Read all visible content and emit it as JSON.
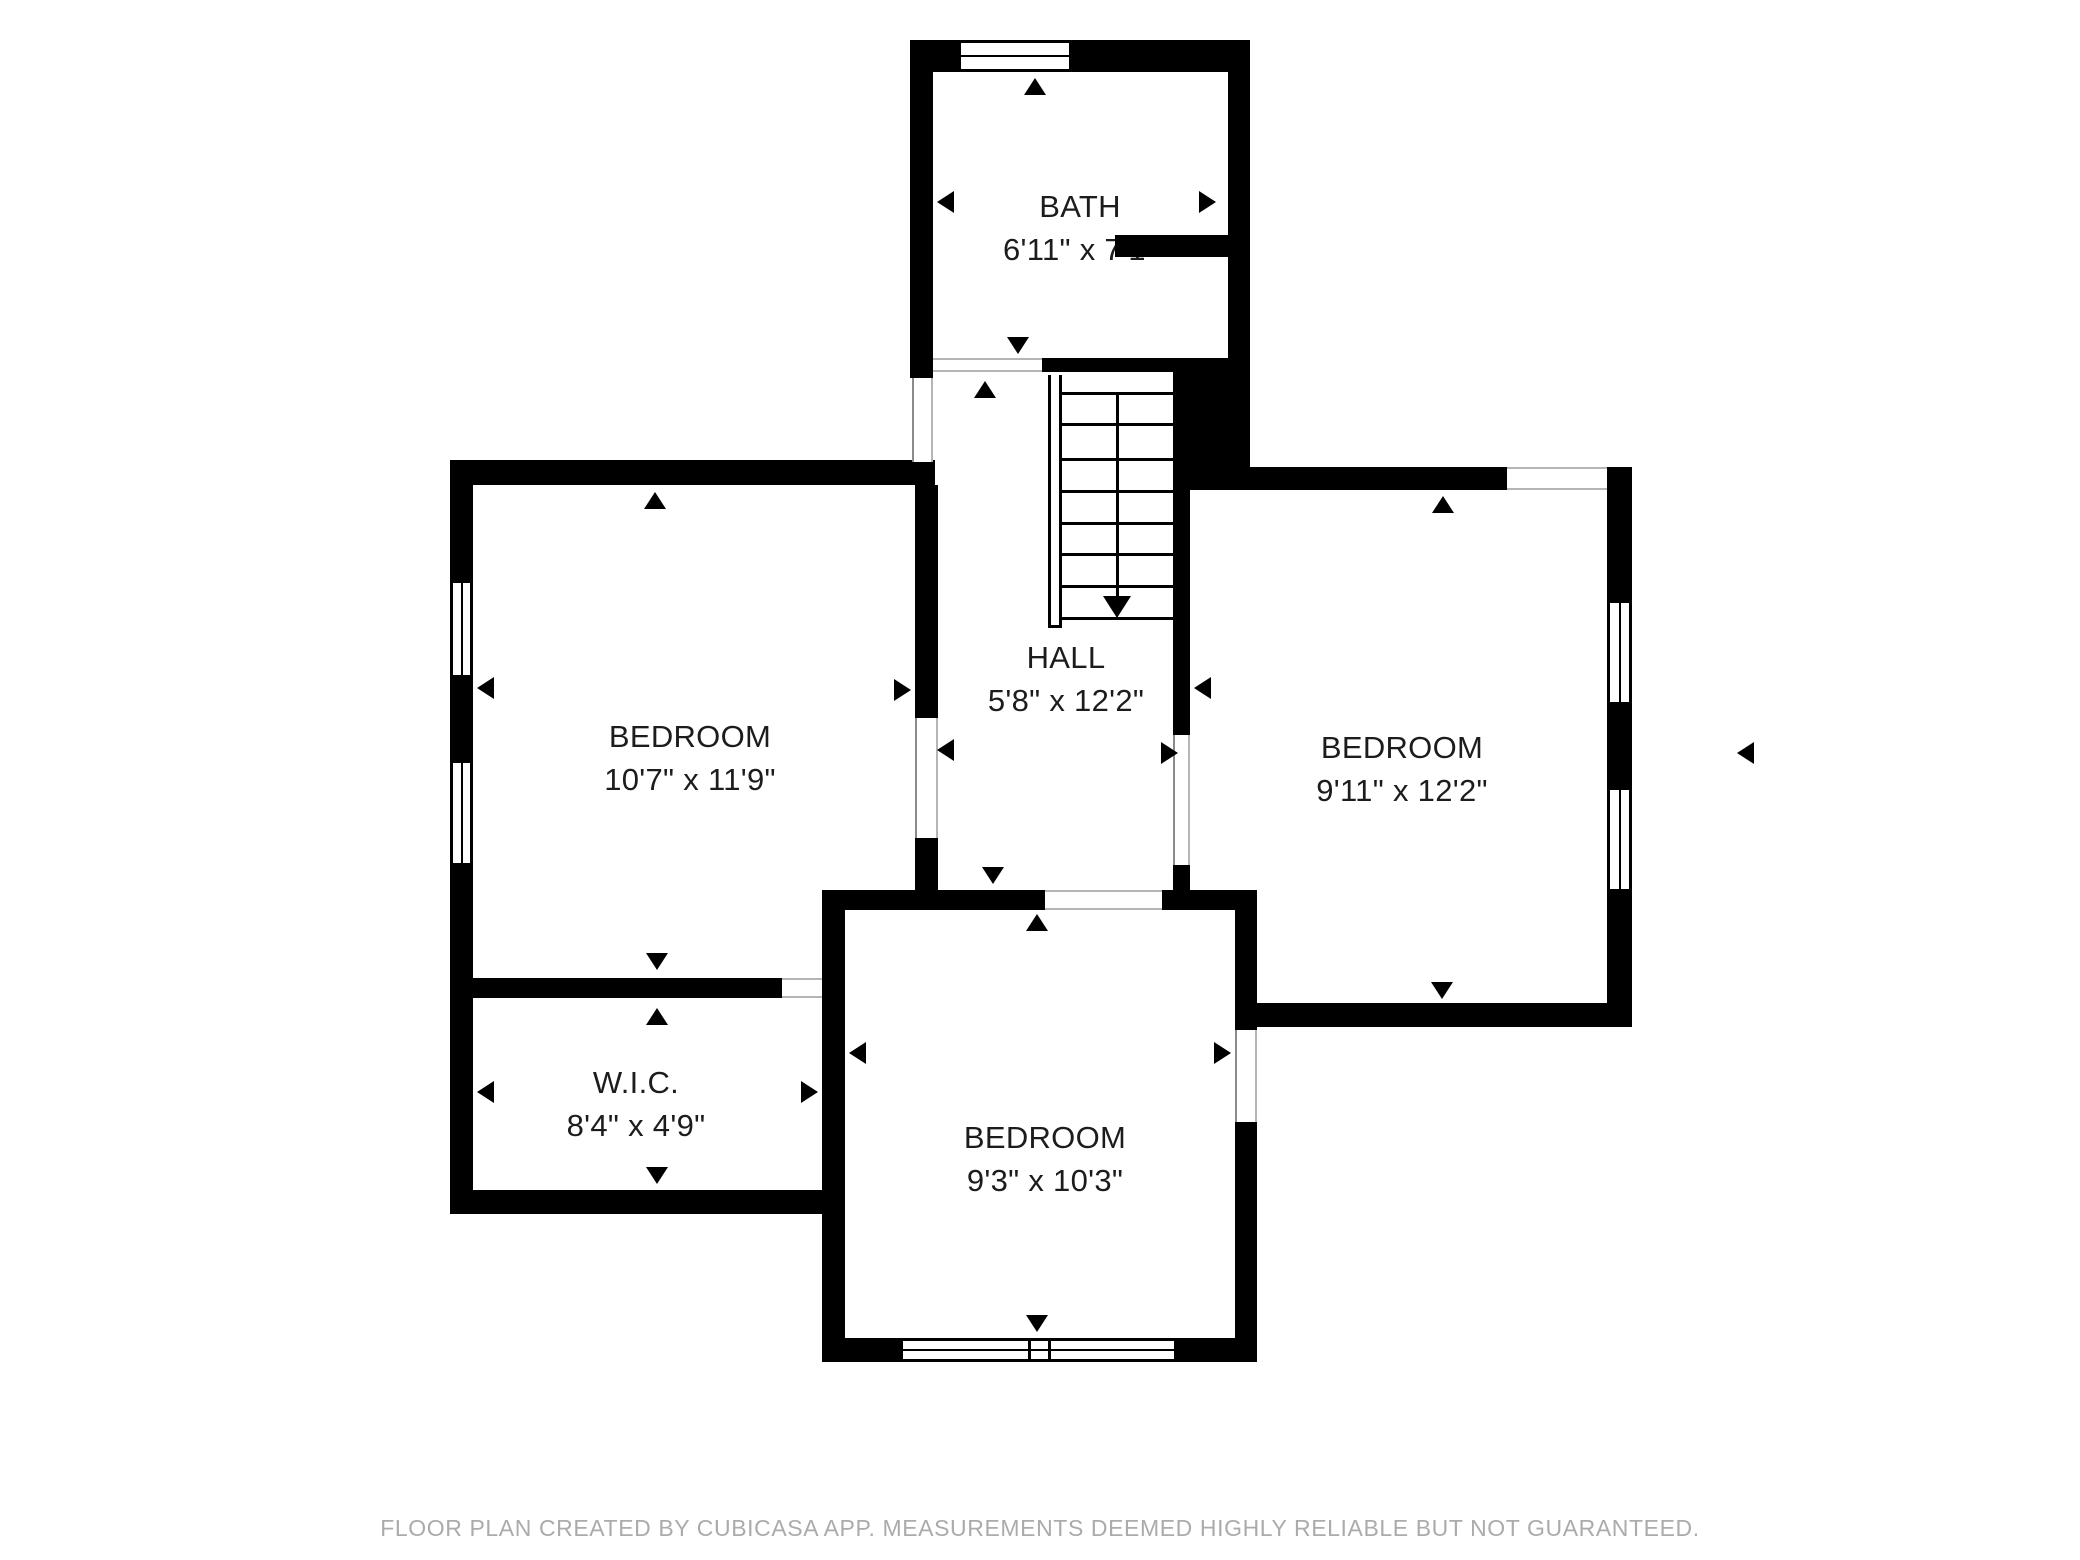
{
  "page": {
    "background": "#ffffff",
    "wall_color": "#000000",
    "label_color": "#1c1c1c",
    "opening_line_color": "#b5b5b5",
    "footer_color": "#ababab"
  },
  "rooms": [
    {
      "id": "bath",
      "name": "BATH",
      "dims": "6'11\" x 7'1\"",
      "cx": 1080,
      "cy": 207
    },
    {
      "id": "hall",
      "name": "HALL",
      "dims": "5'8\" x 12'2\"",
      "cx": 1066,
      "cy": 658
    },
    {
      "id": "bedroom-left",
      "name": "BEDROOM",
      "dims": "10'7\" x 11'9\"",
      "cx": 690,
      "cy": 737
    },
    {
      "id": "bedroom-right",
      "name": "BEDROOM",
      "dims": "9'11\" x 12'2\"",
      "cx": 1402,
      "cy": 748
    },
    {
      "id": "wic",
      "name": "W.I.C.",
      "dims": "8'4\" x 4'9\"",
      "cx": 636,
      "cy": 1083
    },
    {
      "id": "bedroom-bottom",
      "name": "BEDROOM",
      "dims": "9'3\" x 10'3\"",
      "cx": 1045,
      "cy": 1138
    }
  ],
  "footer": {
    "text": "FLOOR PLAN CREATED BY CUBICASA APP. MEASUREMENTS DEEMED HIGHLY RELIABLE BUT NOT GUARANTEED."
  },
  "plan": {
    "walls": [
      [
        910,
        40,
        48,
        32
      ],
      [
        1072,
        40,
        178,
        32
      ],
      [
        910,
        40,
        23,
        338
      ],
      [
        1228,
        40,
        22,
        320
      ],
      [
        1173,
        358,
        77,
        132
      ],
      [
        1115,
        235,
        113,
        22
      ],
      [
        1042,
        358,
        131,
        14
      ],
      [
        1173,
        490,
        17,
        245
      ],
      [
        1173,
        865,
        17,
        27
      ],
      [
        450,
        460,
        485,
        25
      ],
      [
        450,
        460,
        23,
        752
      ],
      [
        915,
        485,
        23,
        233
      ],
      [
        915,
        838,
        23,
        54
      ],
      [
        473,
        978,
        309,
        20
      ],
      [
        822,
        890,
        23,
        472
      ],
      [
        822,
        890,
        223,
        20
      ],
      [
        1162,
        890,
        95,
        20
      ],
      [
        1235,
        890,
        22,
        140
      ],
      [
        1235,
        1122,
        22,
        218
      ],
      [
        822,
        1338,
        78,
        24
      ],
      [
        1177,
        1338,
        80,
        24
      ],
      [
        450,
        1190,
        395,
        24
      ],
      [
        1173,
        467,
        334,
        23
      ],
      [
        1607,
        467,
        25,
        23
      ],
      [
        1607,
        467,
        25,
        133
      ],
      [
        1607,
        705,
        25,
        82
      ],
      [
        1607,
        892,
        25,
        135
      ],
      [
        1248,
        1003,
        384,
        24
      ]
    ],
    "windows": [
      {
        "rect": [
          958,
          40,
          114,
          32
        ],
        "orient": "h",
        "type": "single"
      },
      {
        "rect": [
          450,
          580,
          23,
          98
        ],
        "orient": "v",
        "type": "single"
      },
      {
        "rect": [
          450,
          760,
          23,
          106
        ],
        "orient": "v",
        "type": "single"
      },
      {
        "rect": [
          1607,
          600,
          25,
          105
        ],
        "orient": "v",
        "type": "single"
      },
      {
        "rect": [
          1607,
          787,
          25,
          105
        ],
        "orient": "v",
        "type": "single"
      },
      {
        "rect": [
          900,
          1338,
          277,
          24
        ],
        "orient": "h",
        "type": "double"
      }
    ],
    "openings": [
      {
        "rect": [
          933,
          358,
          109,
          14
        ],
        "orient": "h"
      },
      {
        "rect": [
          912,
          378,
          21,
          84
        ],
        "orient": "v"
      },
      {
        "rect": [
          915,
          718,
          23,
          120
        ],
        "orient": "v"
      },
      {
        "rect": [
          1173,
          735,
          17,
          130
        ],
        "orient": "v"
      },
      {
        "rect": [
          1045,
          890,
          117,
          20
        ],
        "orient": "h"
      },
      {
        "rect": [
          782,
          978,
          40,
          20
        ],
        "orient": "h"
      },
      {
        "rect": [
          1235,
          1030,
          22,
          92
        ],
        "orient": "v"
      },
      {
        "rect": [
          1507,
          467,
          100,
          23
        ],
        "orient": "h"
      }
    ],
    "arrows": [
      [
        937,
        202,
        "left"
      ],
      [
        1216,
        202,
        "right"
      ],
      [
        1035,
        78,
        "up"
      ],
      [
        1018,
        354,
        "down"
      ],
      [
        985,
        381,
        "up"
      ],
      [
        937,
        750,
        "left"
      ],
      [
        1178,
        753,
        "right"
      ],
      [
        993,
        884,
        "down"
      ],
      [
        1037,
        914,
        "up"
      ],
      [
        477,
        688,
        "left"
      ],
      [
        911,
        690,
        "right"
      ],
      [
        655,
        492,
        "up"
      ],
      [
        657,
        970,
        "down"
      ],
      [
        477,
        1092,
        "left"
      ],
      [
        818,
        1092,
        "right"
      ],
      [
        657,
        1008,
        "up"
      ],
      [
        657,
        1184,
        "down"
      ],
      [
        849,
        1053,
        "left"
      ],
      [
        1231,
        1053,
        "right"
      ],
      [
        1037,
        1332,
        "down"
      ],
      [
        1194,
        688,
        "left"
      ],
      [
        1443,
        496,
        "up"
      ],
      [
        1442,
        999,
        "down"
      ],
      [
        1737,
        753,
        "left"
      ]
    ],
    "stairs": {
      "rail": [
        1048,
        375,
        14,
        253
      ],
      "tread_x1": 1062,
      "tread_x2": 1173,
      "tread_ys": [
        392,
        423,
        458,
        490,
        522,
        553,
        585,
        617
      ],
      "center_x": 1117,
      "center_y1": 392,
      "center_y2": 598,
      "arrow_tip": [
        1117,
        618
      ]
    }
  }
}
